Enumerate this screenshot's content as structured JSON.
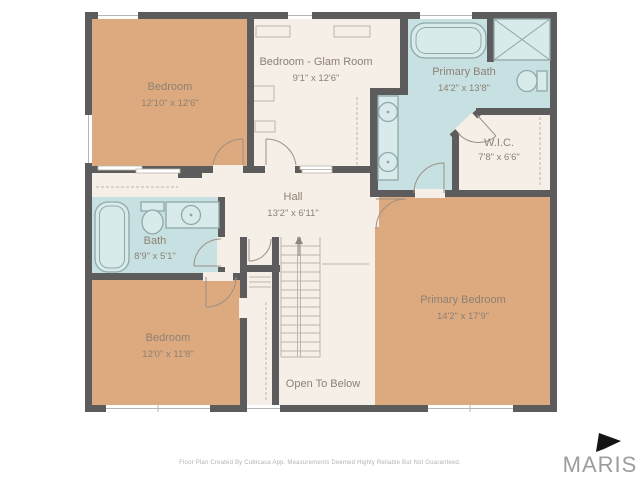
{
  "colors": {
    "background": "#ffffff",
    "wall": "#5d5c5c",
    "bedroom_fill": "#dda97e",
    "common_fill": "#f6efe7",
    "bath_fill": "#c7e0e1",
    "fixture_fill": "#d8eaea",
    "fixture_stroke": "#8fa8aa",
    "detail_line": "#bdb5a8",
    "label_text": "#8d8174",
    "footer_text": "#b3b3b3",
    "logo_text": "#9c9c9c",
    "logo_flag": "#141414"
  },
  "rooms": {
    "bedroom_top_left": {
      "name": "Bedroom",
      "dimensions": "12'10\" x 12'6\""
    },
    "glam_room": {
      "name": "Bedroom - Glam Room",
      "dimensions": "9'1\" x 12'6\""
    },
    "primary_bath": {
      "name": "Primary Bath",
      "dimensions": "14'2\" x 13'8\""
    },
    "wic": {
      "name": "W.I.C.",
      "dimensions": "7'8\" x 6'6\""
    },
    "hall": {
      "name": "Hall",
      "dimensions": "13'2\" x 6'11\""
    },
    "bath": {
      "name": "Bath",
      "dimensions": "8'9\" x 5'1\""
    },
    "bedroom_bottom_left": {
      "name": "Bedroom",
      "dimensions": "12'0\" x 11'8\""
    },
    "primary_bedroom": {
      "name": "Primary Bedroom",
      "dimensions": "14'2\" x 17'9\""
    },
    "open_to_below": {
      "name": "Open To Below"
    }
  },
  "footer": {
    "disclaimer": "Floor Plan Created By Cubicasa App. Measurements Deemed Highly Reliable But Not Guaranteed."
  },
  "branding": {
    "logo_text": "MARIS"
  }
}
